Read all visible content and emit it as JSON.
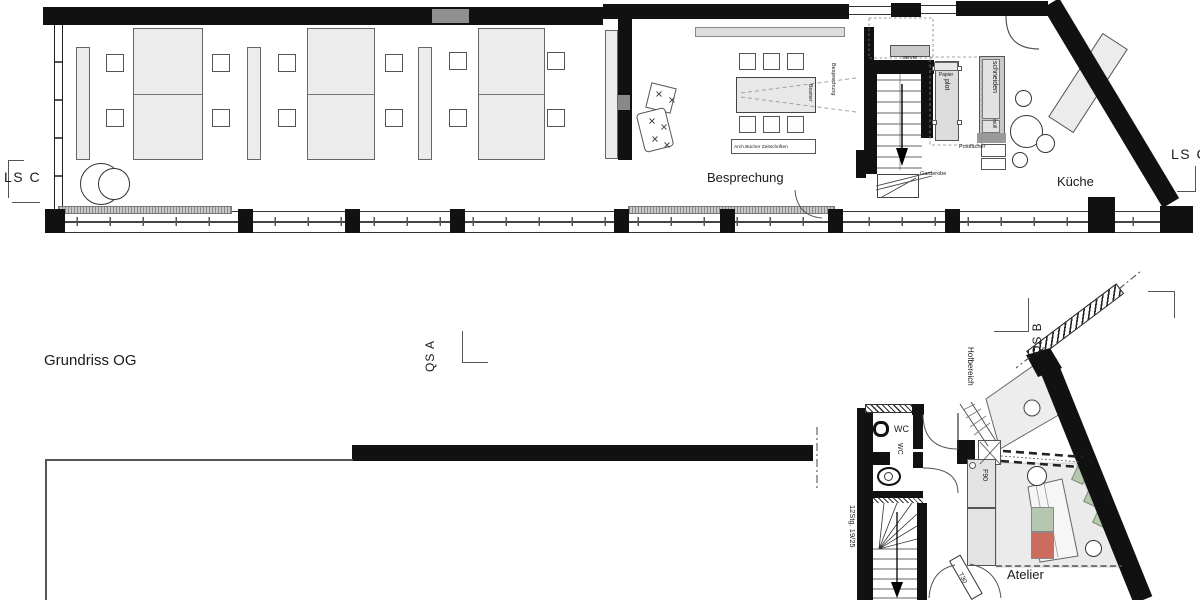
{
  "title": {
    "plan_label": "Grundriss OG"
  },
  "sections": {
    "ls_left": "LS C",
    "ls_right": "LS C",
    "qs_a": "QS A",
    "qs_b": "QS B"
  },
  "upper": {
    "rooms": {
      "besprechung": "Besprechung",
      "kueche": "Küche"
    },
    "labels": {
      "server": "server",
      "papier": "Papier",
      "plot": "plot",
      "schneiden": "schneiden",
      "muell": "müll",
      "postfaecher": "Postfächer",
      "garderobe": "Garderobe",
      "beamer": "Beamer",
      "besprechung_vertical": "Besprechung",
      "shelf": "Arch.Bücher Zeitschriften"
    }
  },
  "lower": {
    "rooms": {
      "wc": "WC",
      "atelier": "Atelier"
    },
    "labels": {
      "wc_vertical": "WC",
      "stairs": "12Stg. 19/25",
      "hofbereich": "Hofbereich",
      "fire_door": "T30",
      "fire_cabinet": "F90"
    }
  },
  "colors": {
    "wall": "#111111",
    "line": "#555555",
    "fill_light": "#ececec",
    "green": "#b5c7ae",
    "red": "#cd6b5c"
  }
}
